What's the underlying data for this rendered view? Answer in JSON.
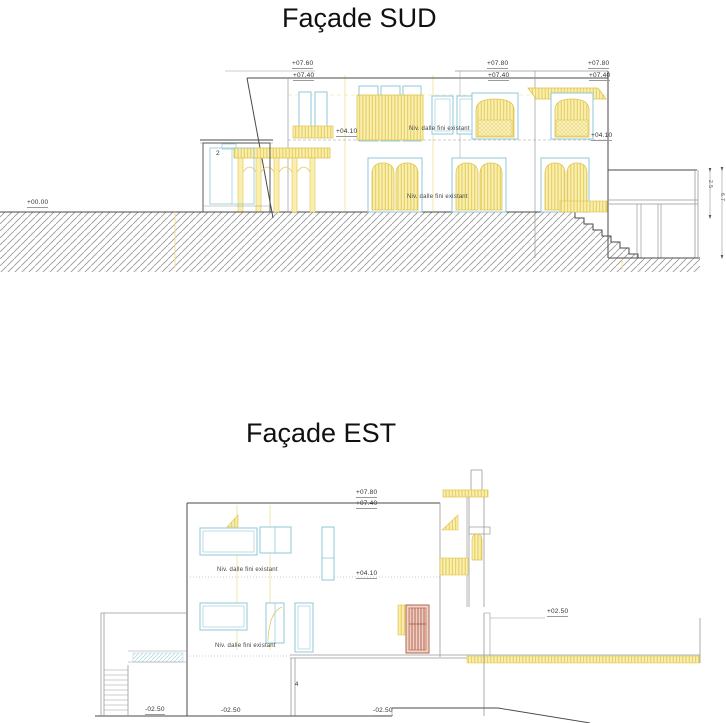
{
  "colors": {
    "line": "#4a4a4a",
    "yellow_fill": "#f9efae",
    "yellow_stroke": "#e0c44e",
    "blue_stroke": "#8fc9d8",
    "red_door": "#b5644c",
    "terrain_hatch": "#969696"
  },
  "sud": {
    "title": "Façade SUD",
    "levels": [
      {
        "text": "+07.60"
      },
      {
        "text": "+07.40"
      },
      {
        "text": "+07.80"
      },
      {
        "text": "+07.40"
      },
      {
        "text": "+07.80"
      },
      {
        "text": "+07.40"
      },
      {
        "text": "+04.10"
      },
      {
        "text": "+04.10"
      },
      {
        "text": "+00.00"
      }
    ],
    "notes": [
      {
        "text": "Niv. dalle fini existant"
      },
      {
        "text": "Niv. dalle fini existant"
      }
    ],
    "room_number": "2",
    "dims": [
      {
        "text": "2.5"
      },
      {
        "text": "6.7"
      }
    ]
  },
  "est": {
    "title": "Façade EST",
    "levels": [
      {
        "text": "+07.80"
      },
      {
        "text": "+07.40"
      },
      {
        "text": "+04.10"
      },
      {
        "text": "+02.50"
      },
      {
        "text": "-02.50"
      },
      {
        "text": "-02.50"
      },
      {
        "text": "-02.50"
      }
    ],
    "notes": [
      {
        "text": "Niv. dalle fini existant"
      },
      {
        "text": "Niv. dalle fini existant"
      }
    ],
    "room_number": "4"
  }
}
